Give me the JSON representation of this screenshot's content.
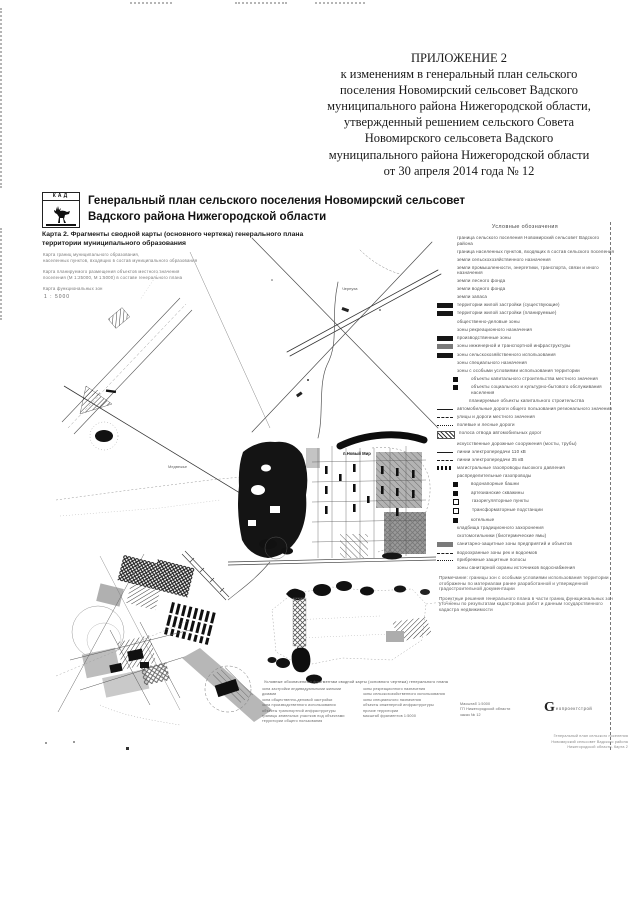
{
  "appendix": {
    "lines": [
      "ПРИЛОЖЕНИЕ 2",
      "к изменениям в генеральный план сельского",
      "поселения Новомирский сельсовет Вадского",
      "муниципального района Нижегородской области,",
      "утвержденный решением сельского Совета",
      "Новомирского сельсовета Вадского",
      "муниципального района Нижегородской области",
      "от 30 апреля 2014 года № 12"
    ]
  },
  "sheet": {
    "logo": {
      "caption": "КАД",
      "icon": "deer-emblem"
    },
    "title": {
      "line1": "Генеральный план сельского поселения Новомирский сельсовет",
      "line2": "Вадского района Нижегородской области"
    },
    "subtitle": {
      "line1": "Карта 2. Фрагменты сводной карты (основного чертежа) генерального плана",
      "line2": "территории муниципального образования"
    },
    "meta_lines": [
      {
        "t": "Карта границ муниципального образования,",
        "gap": ""
      },
      {
        "t": "населенных пунктов, входящих в состав муниципального образования",
        "gap": ""
      },
      {
        "t": "Карта планируемого размещения объектов местного значения",
        "gap": "gap"
      },
      {
        "t": "поселения (М 1:25000, М 1:5000) в составе генерального плана",
        "gap": ""
      },
      {
        "t": "Карта функциональных зон",
        "gap": "gap"
      }
    ],
    "scale": "1 : 5000",
    "map_labels": {
      "settlement": "п.Новый Мир",
      "village_ne": "Чернуха",
      "locality_w": "Медвежье"
    },
    "legend": {
      "header": "Условные обозначения",
      "items": [
        {
          "sw": "none",
          "row_class": "",
          "t": "граница сельского поселения Новомирский сельсовет Вадского района"
        },
        {
          "sw": "none",
          "row_class": "",
          "t": "граница населенных пунктов, входящих в состав сельского поселения"
        },
        {
          "sw": "none",
          "row_class": "",
          "t": "земли сельскохозяйственного назначения"
        },
        {
          "sw": "none",
          "row_class": "",
          "t": "земли промышленности, энергетики, транспорта, связи и иного назначения"
        },
        {
          "sw": "none",
          "row_class": "",
          "t": "земли лесного фонда"
        },
        {
          "sw": "none",
          "row_class": "",
          "t": "земли водного фонда"
        },
        {
          "sw": "none",
          "row_class": "",
          "t": "земли запаса"
        },
        {
          "sw": "blackbar",
          "row_class": "",
          "t": "территории жилой застройки (существующие)"
        },
        {
          "sw": "blackbar",
          "row_class": "",
          "t": "территории жилой застройки (планируемые)"
        },
        {
          "sw": "none",
          "row_class": "",
          "t": "общественно-деловые зоны"
        },
        {
          "sw": "none",
          "row_class": "",
          "t": "зоны рекреационного назначения"
        },
        {
          "sw": "blackbar",
          "row_class": "",
          "t": "производственные зоны"
        },
        {
          "sw": "graybar",
          "row_class": "",
          "t": "зоны инженерной и транспортной инфраструктуры"
        },
        {
          "sw": "blackbar",
          "row_class": "",
          "t": "зоны сельскохозяйственного использования"
        },
        {
          "sw": "none",
          "row_class": "",
          "t": "зоны специального назначения"
        },
        {
          "sw": "none",
          "row_class": "",
          "t": "зоны с особыми условиями использования территории"
        },
        {
          "sw": "sq",
          "row_class": "ind1",
          "t": "объекты капитального строительства местного значения"
        },
        {
          "sw": "sq",
          "row_class": "ind1",
          "t": "объекты социального и культурно-бытового обслуживания населения"
        },
        {
          "sw": "none",
          "row_class": "ind1",
          "t": "планируемые объекты капитального строительства"
        },
        {
          "sw": "line",
          "row_class": "",
          "t": "автомобильные дороги общего пользования регионального значения"
        },
        {
          "sw": "dash",
          "row_class": "",
          "t": "улицы и дороги местного значения"
        },
        {
          "sw": "dot",
          "row_class": "",
          "t": "полевые и лесные дороги"
        },
        {
          "sw": "hatch",
          "row_class": "",
          "t": "полоса отвода автомобильных дорог"
        },
        {
          "sw": "none",
          "row_class": "",
          "t": "искусственные дорожные сооружения (мосты, трубы)"
        },
        {
          "sw": "line",
          "row_class": "",
          "t": "линии электропередачи 110 кВ"
        },
        {
          "sw": "dash",
          "row_class": "",
          "t": "линии электропередачи 35 кВ"
        },
        {
          "sw": "stripe",
          "row_class": "",
          "t": "магистральные газопроводы высокого давления"
        },
        {
          "sw": "none",
          "row_class": "",
          "t": "распределительные газопроводы"
        },
        {
          "sw": "sq",
          "row_class": "ind1",
          "t": "водонапорные башни"
        },
        {
          "sw": "sq",
          "row_class": "ind1",
          "t": "артезианские скважины"
        },
        {
          "sw": "icon",
          "row_class": "ind1",
          "t": "газорегуляторные пункты"
        },
        {
          "sw": "icon",
          "row_class": "ind1",
          "t": "трансформаторные подстанции"
        },
        {
          "sw": "sq",
          "row_class": "ind1",
          "t": "котельные"
        },
        {
          "sw": "none",
          "row_class": "",
          "t": "кладбища традиционного захоронения"
        },
        {
          "sw": "none",
          "row_class": "",
          "t": "скотомогильники (биотермические ямы)"
        },
        {
          "sw": "graybar",
          "row_class": "",
          "t": "санитарно-защитные зоны предприятий и объектов"
        },
        {
          "sw": "dash",
          "row_class": "",
          "t": "водоохранные зоны рек и водоемов"
        },
        {
          "sw": "dot",
          "row_class": "",
          "t": "прибрежные защитные полосы"
        },
        {
          "sw": "none",
          "row_class": "",
          "t": "зоны санитарной охраны источников водоснабжения"
        },
        {
          "sw": "none",
          "row_class": "para",
          "t": "Примечание: границы зон с особыми условиями использования территории отображены по материалам ранее разработанной и утвержденной градостроительной документации"
        },
        {
          "sw": "none",
          "row_class": "para",
          "t": "Проектные решения генерального плана в части границ функциональных зон уточнены по результатам кадастровых работ и данным государственного кадастра недвижимости"
        }
      ]
    },
    "mini_legend": {
      "heading": "Условные обозначения к фрагментам сводной карты (основного чертежа) генерального плана",
      "col1": [
        "зона застройки индивидуальными жилыми домами",
        "зона общественно-деловой застройки",
        "зона производственного использования",
        "объекты транспортной инфраструктуры",
        "границы земельных участков под объектами",
        "территории общего пользования"
      ],
      "col2": [
        "зоны рекреационного назначения",
        "зоны сельскохозяйственного использования",
        "зоны специального назначения",
        "объекты инженерной инфраструктуры",
        "прочие территории",
        "масштаб фрагментов 1:5000"
      ]
    },
    "publisher": {
      "left_lines": [
        "Масштаб 1:5000",
        "ГП Нижегородской области",
        "заказ № 12"
      ],
      "logo_letter": "G",
      "logo_text": "еопроектстрой",
      "footer_lines": [
        "Генеральный план сельского поселения",
        "Новомирский сельсовет Вадского района",
        "Нижегородской области. Карта 2"
      ]
    }
  }
}
